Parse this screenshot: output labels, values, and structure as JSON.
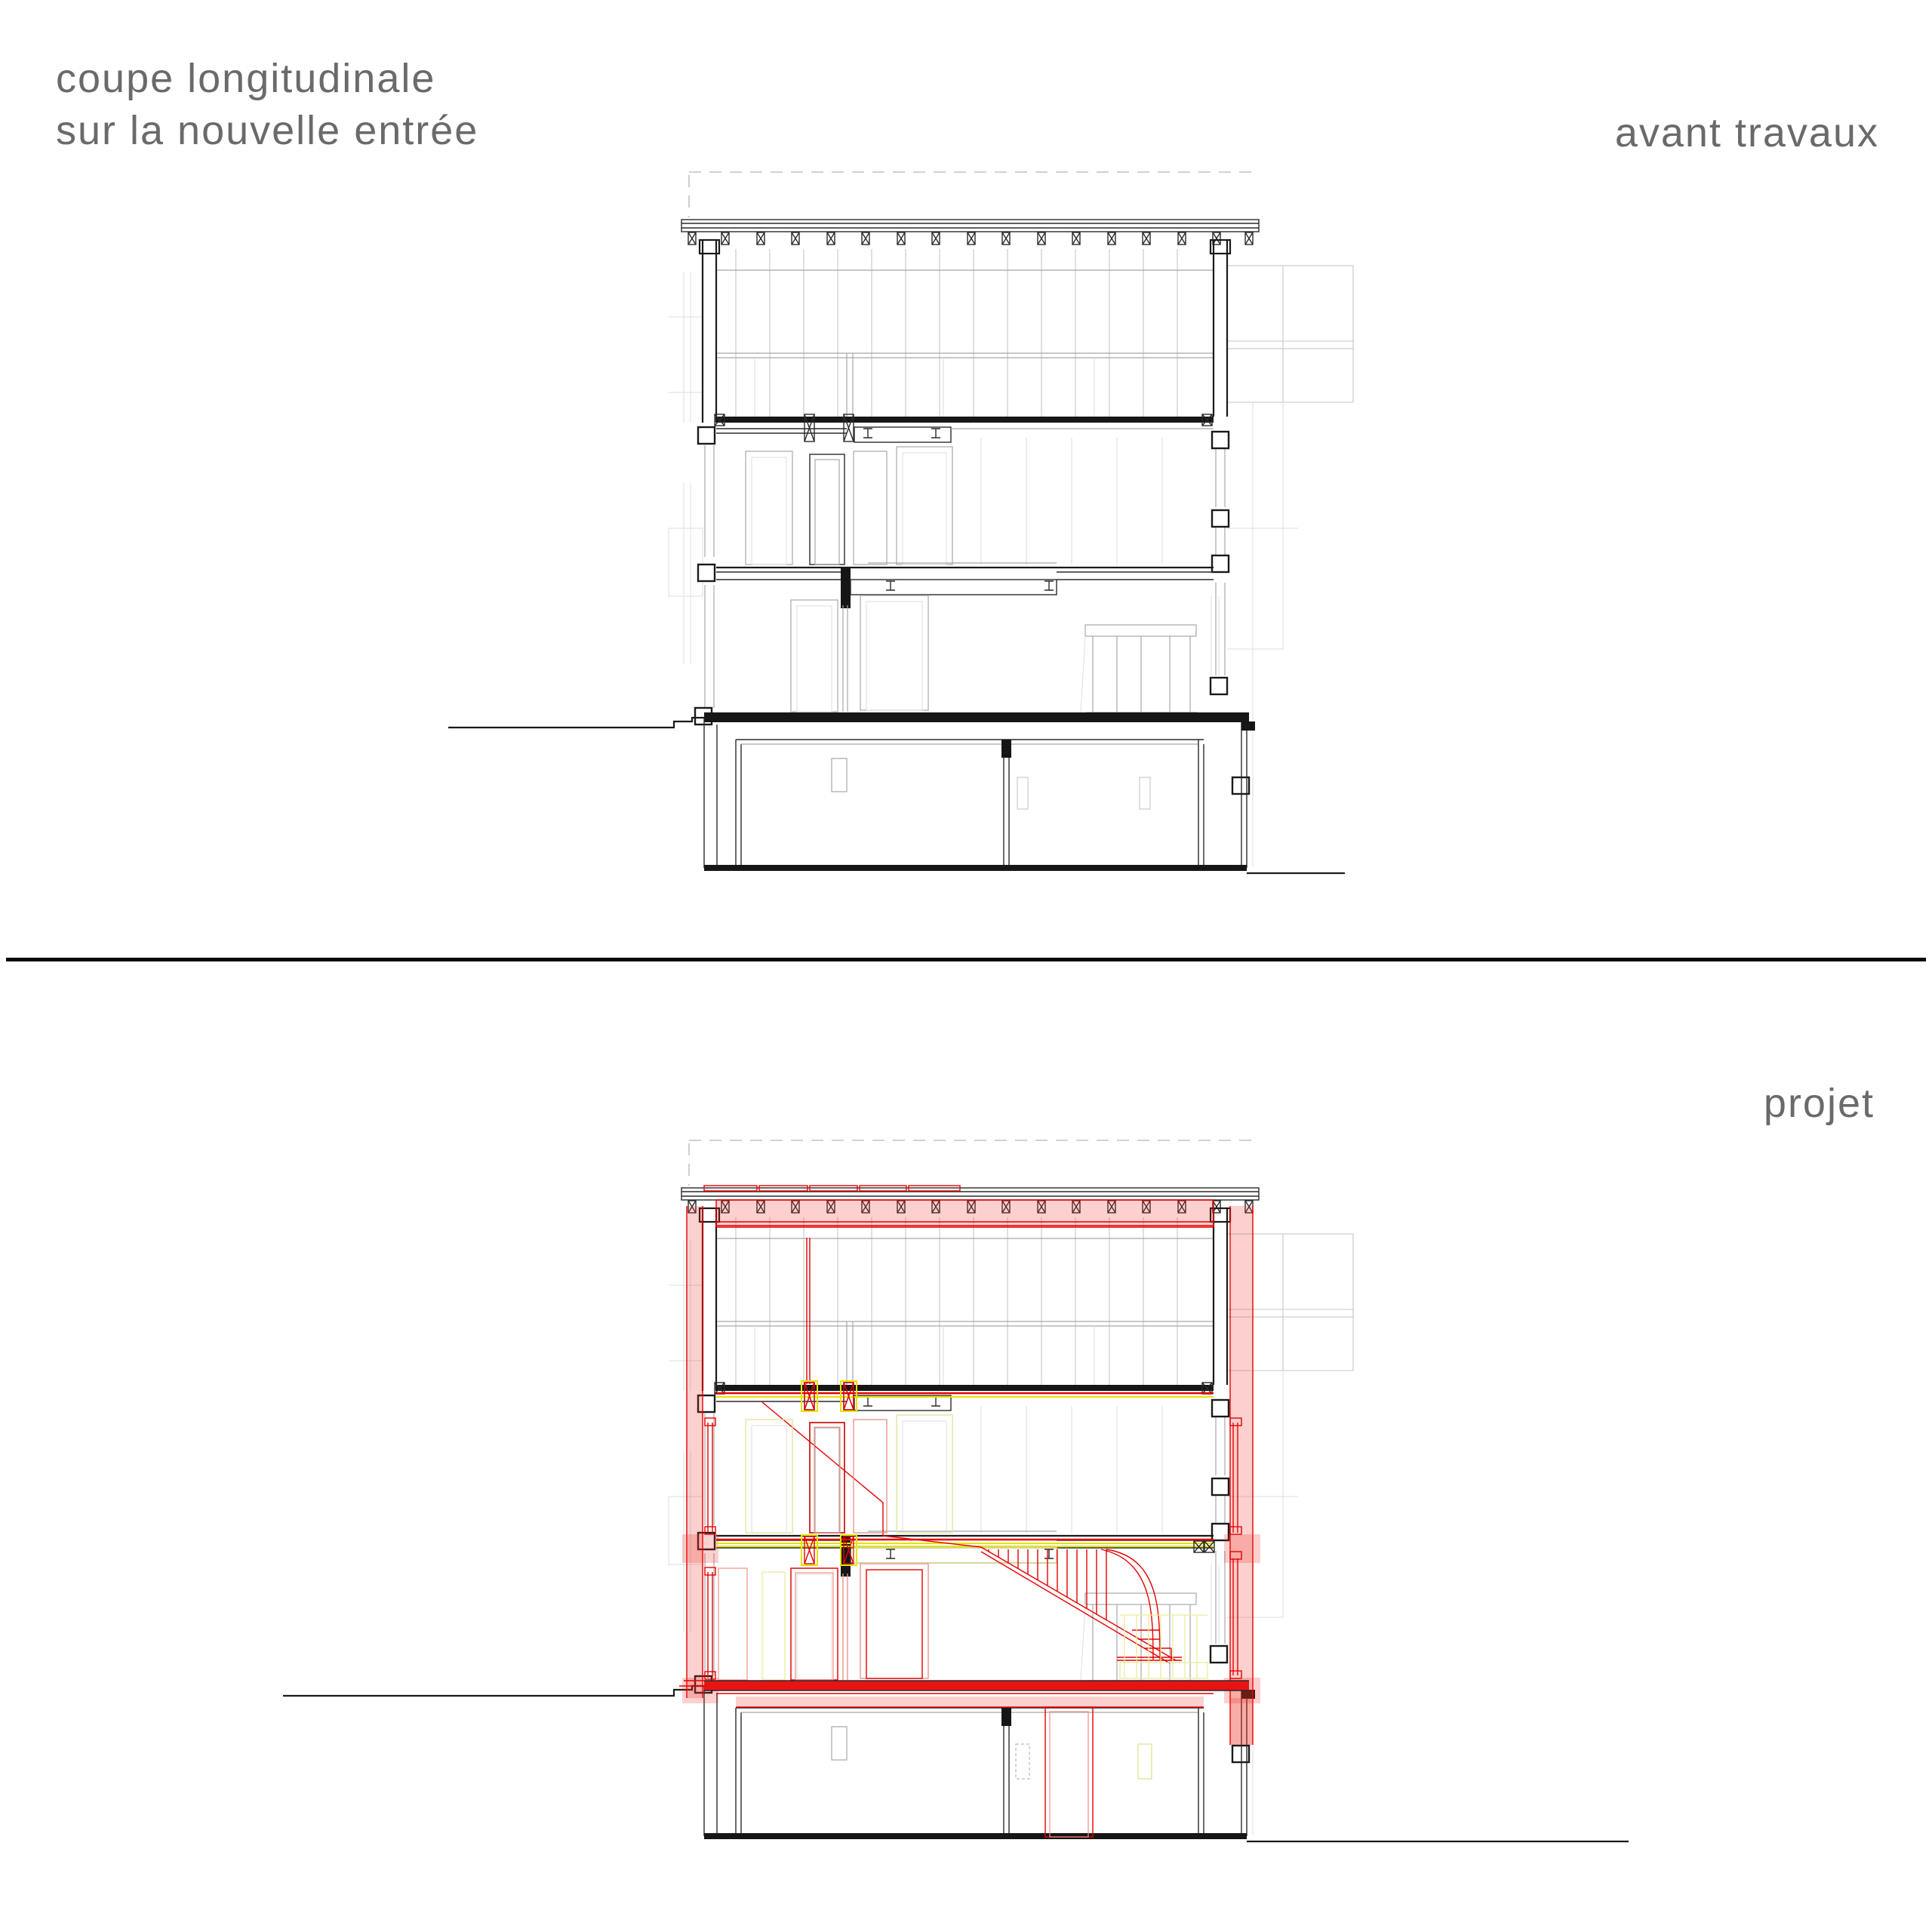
{
  "sheet": {
    "title_line1": "coupe longitudinale",
    "title_line2": "sur la nouvelle entrée",
    "section_top_label": "avant travaux",
    "section_bottom_label": "projet"
  },
  "drawings": [
    {
      "name": "coupe avant travaux",
      "style": "existing state, black and gray linework"
    },
    {
      "name": "coupe projet",
      "style": "project state with new works in red/pink and demolition in yellow, new staircase at ground floor"
    }
  ],
  "colors": {
    "paper": "#ffffff",
    "line_black": "#1a1a1a",
    "elevation_gray": "#c7c7c7",
    "title_gray": "#6a6a6a",
    "new_work_red": "#e60000",
    "new_wall_pink": "#f5b0ab",
    "demolition_yellow": "#e3e300",
    "divider_black": "#0b0b0b"
  }
}
